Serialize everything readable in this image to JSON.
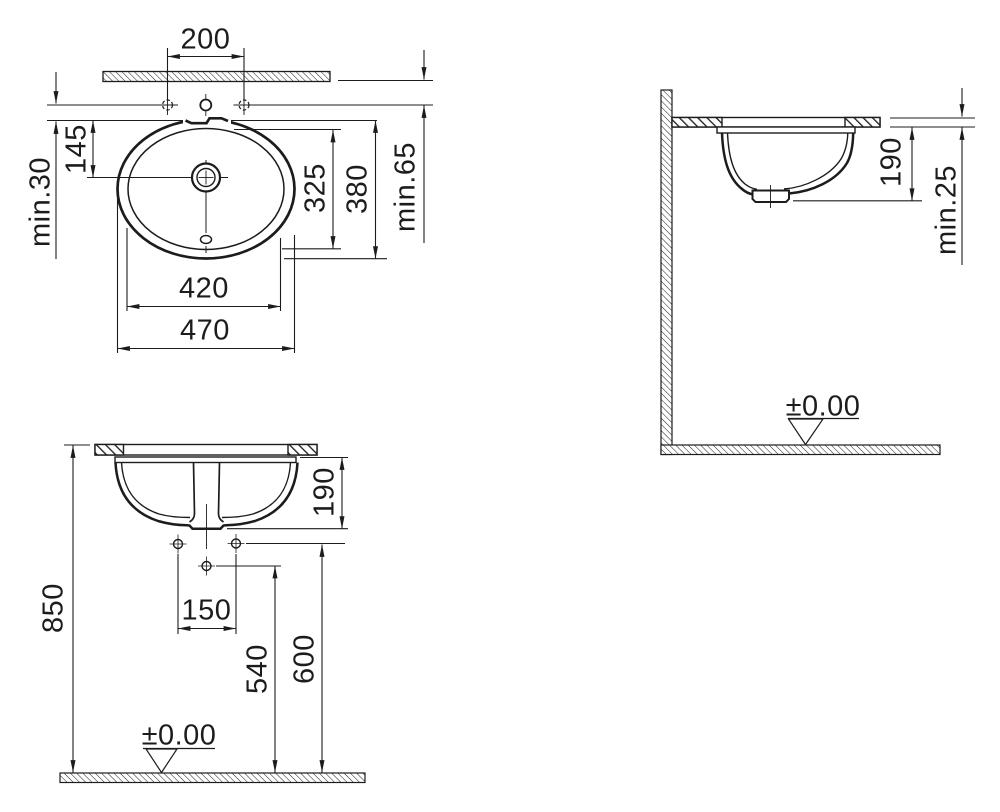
{
  "drawing": {
    "type": "washbasin installation technical drawing",
    "colors": {
      "line": "#1c1c1c",
      "background": "#ffffff"
    },
    "plan": {
      "tap_hole_spacing": "200",
      "rim_to_drain": "145",
      "edge_min": "min.30",
      "bowl_length": "325",
      "overall_length": "380",
      "wall_min": "min.65",
      "bowl_width": "420",
      "overall_width": "470"
    },
    "side": {
      "bowl_depth": "190",
      "counter_min": "min.25",
      "floor_level": "±0.00"
    },
    "front": {
      "bowl_depth": "190",
      "mounting_height": "850",
      "hole_spacing": "150",
      "trap_height": "540",
      "supply_height": "600",
      "floor_level": "±0.00"
    }
  }
}
